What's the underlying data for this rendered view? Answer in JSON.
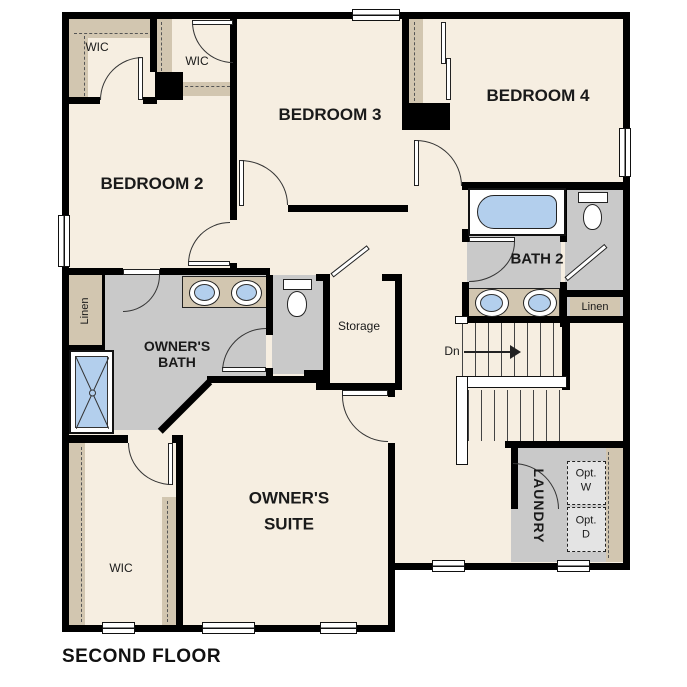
{
  "title": "SECOND FLOOR",
  "rooms": {
    "wic_top_left": "WIC",
    "wic_top_mid": "WIC",
    "bedroom2": "BEDROOM 2",
    "bedroom3": "BEDROOM 3",
    "bedroom4": "BEDROOM 4",
    "bath2": "BATH 2",
    "owners_bath": [
      "OWNER'S",
      "BATH"
    ],
    "owners_suite": [
      "OWNER'S",
      "SUITE"
    ],
    "storage": "Storage",
    "laundry": "LAUNDRY",
    "wic_owner": "WIC",
    "linen_hall": "Linen",
    "linen_bath": "Linen"
  },
  "annotations": {
    "stairs_down": "Dn",
    "opt_washer": [
      "Opt.",
      "W"
    ],
    "opt_dryer": [
      "Opt.",
      "D"
    ]
  },
  "fixtures": [
    "bathtub",
    "toilet",
    "double-sink-vanity",
    "shower",
    "stairs",
    "optional-washer",
    "optional-dryer",
    "closet-rods",
    "windows",
    "doors"
  ],
  "colors": {
    "floor": "#f6eee1",
    "wall": "#000000",
    "closet_tan": "#d2c6b0",
    "bath_gray": "#c9c9c9",
    "fixture_blue": "#b3cfed",
    "appliance_gray": "#e4e4e4",
    "background": "#ffffff"
  }
}
